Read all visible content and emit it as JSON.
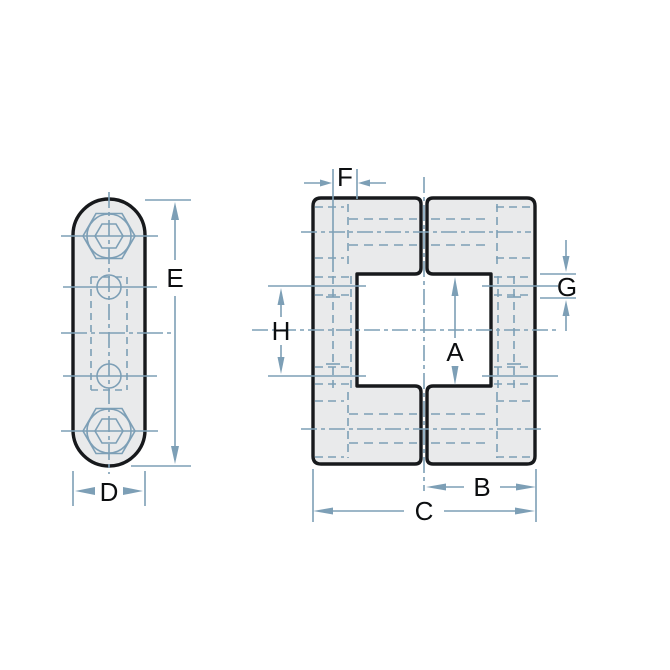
{
  "drawing": {
    "type": "engineering-dimension-drawing",
    "views": {
      "side_view": "stadium-shaped plate with two hex socket bolts, two small holes and hidden center pocket",
      "front_view": "two mirrored bracket halves forming a square center bore with top and bottom slits"
    }
  },
  "labels": {
    "A": "A",
    "B": "B",
    "C": "C",
    "D": "D",
    "E": "E",
    "F": "F",
    "G": "G",
    "H": "H"
  },
  "colors": {
    "background": "#ffffff",
    "part_fill": "#e9eaeb",
    "part_outline": "#17191c",
    "annotation_line": "#7d9fb6",
    "label_text": "#0c0e10"
  }
}
